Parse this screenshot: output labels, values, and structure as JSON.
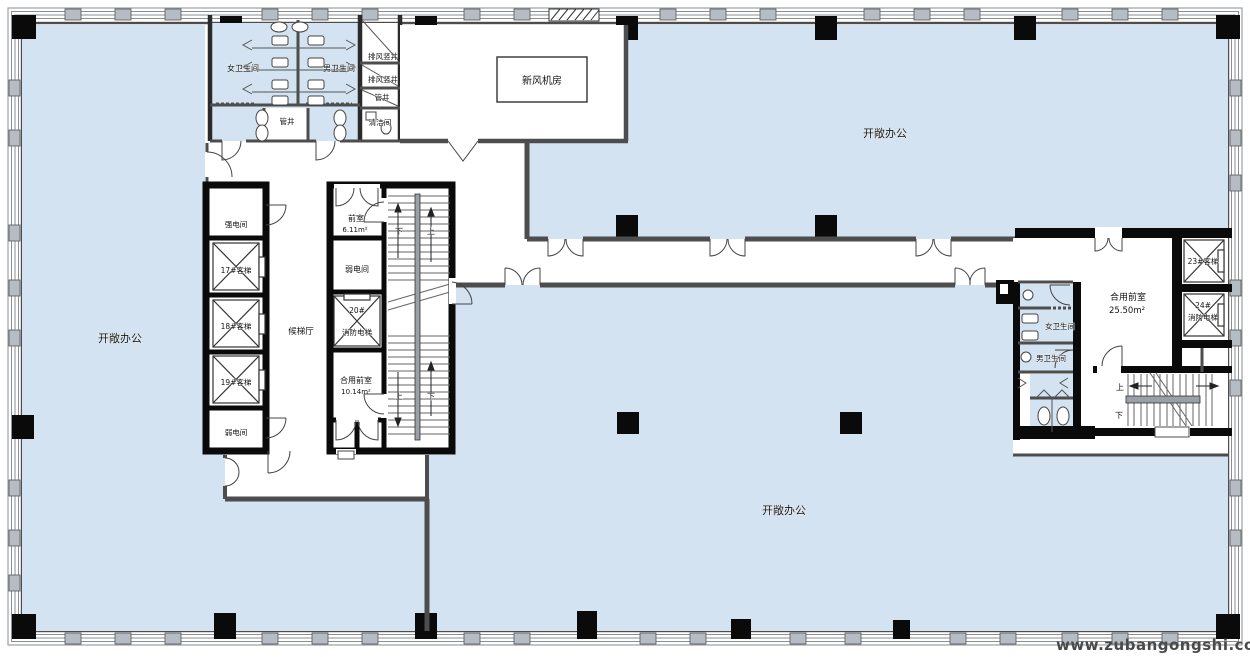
{
  "plan": {
    "type": "office-tower-floor-plan",
    "colors": {
      "open_office_fill": "#d4e3f1",
      "wall_dark": "#4d4d4d",
      "core_black": "#0a0a0a",
      "facade_gray": "#b5bcc4",
      "room_white": "#ffffff"
    },
    "labels": {
      "open_office_left": "开敞办公",
      "open_office_top_right": "开敞办公",
      "open_office_bottom": "开敞办公",
      "womens_restroom_top": "女卫生间",
      "mens_restroom_top": "男卫生间",
      "exhaust_shaft_1": "排风竖井",
      "exhaust_shaft_2": "排风竖井",
      "pipe_shaft_small": "管井",
      "pipe_shaft_room": "管井",
      "cleaning_room": "清洁间",
      "fresh_air_plant_room": "新风机房",
      "strong_electric_room": "强电间",
      "elevator_17": "17#客梯",
      "elevator_18": "18#客梯",
      "elevator_19": "19#客梯",
      "weak_electric_room_lower": "弱电间",
      "elevator_lobby": "候梯厅",
      "anteroom": "前室",
      "anteroom_area": "6.11m²",
      "weak_electric_room_mid": "弱电间",
      "elevator_20_no": "20#",
      "elevator_20_name": "消防电梯",
      "shared_anteroom_left": "合用前室",
      "shared_anteroom_left_area": "10.14m²",
      "stair_left_down_top": "下",
      "stair_left_up_top": "上",
      "stair_left_up_bottom": "上",
      "stair_left_down_bottom": "下",
      "shared_anteroom_right": "合用前室",
      "shared_anteroom_right_area": "25.50m²",
      "elevator_23": "23#客梯",
      "elevator_24_no": "24#",
      "elevator_24_name": "消防电梯",
      "womens_restroom_right": "女卫生间",
      "mens_restroom_right": "男卫生间",
      "stair_right_up": "上",
      "stair_right_down": "下"
    },
    "watermark": "www.zubangongshi.com"
  }
}
